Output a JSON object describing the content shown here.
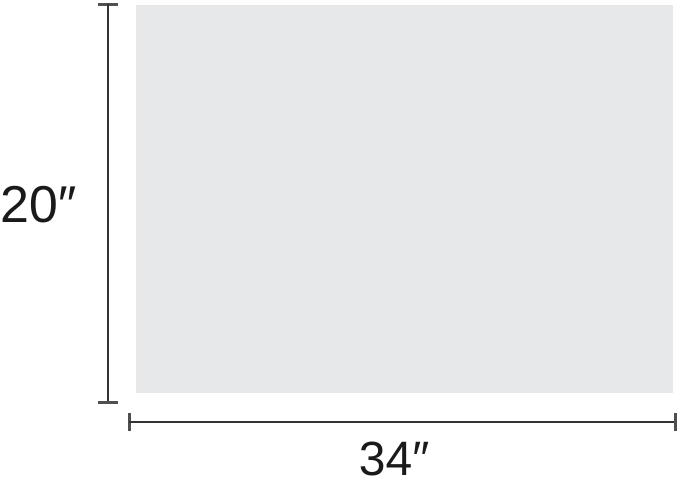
{
  "diagram": {
    "type": "product-dimension-diagram",
    "dimensions": {
      "height": {
        "label": "20″"
      },
      "width": {
        "label": "34″"
      }
    },
    "colors": {
      "background": "#ffffff",
      "surface": "#e7e8e9",
      "dimension_line": "#333333",
      "tick": "#4f4f4f",
      "label_text": "#1a1a1a"
    }
  }
}
